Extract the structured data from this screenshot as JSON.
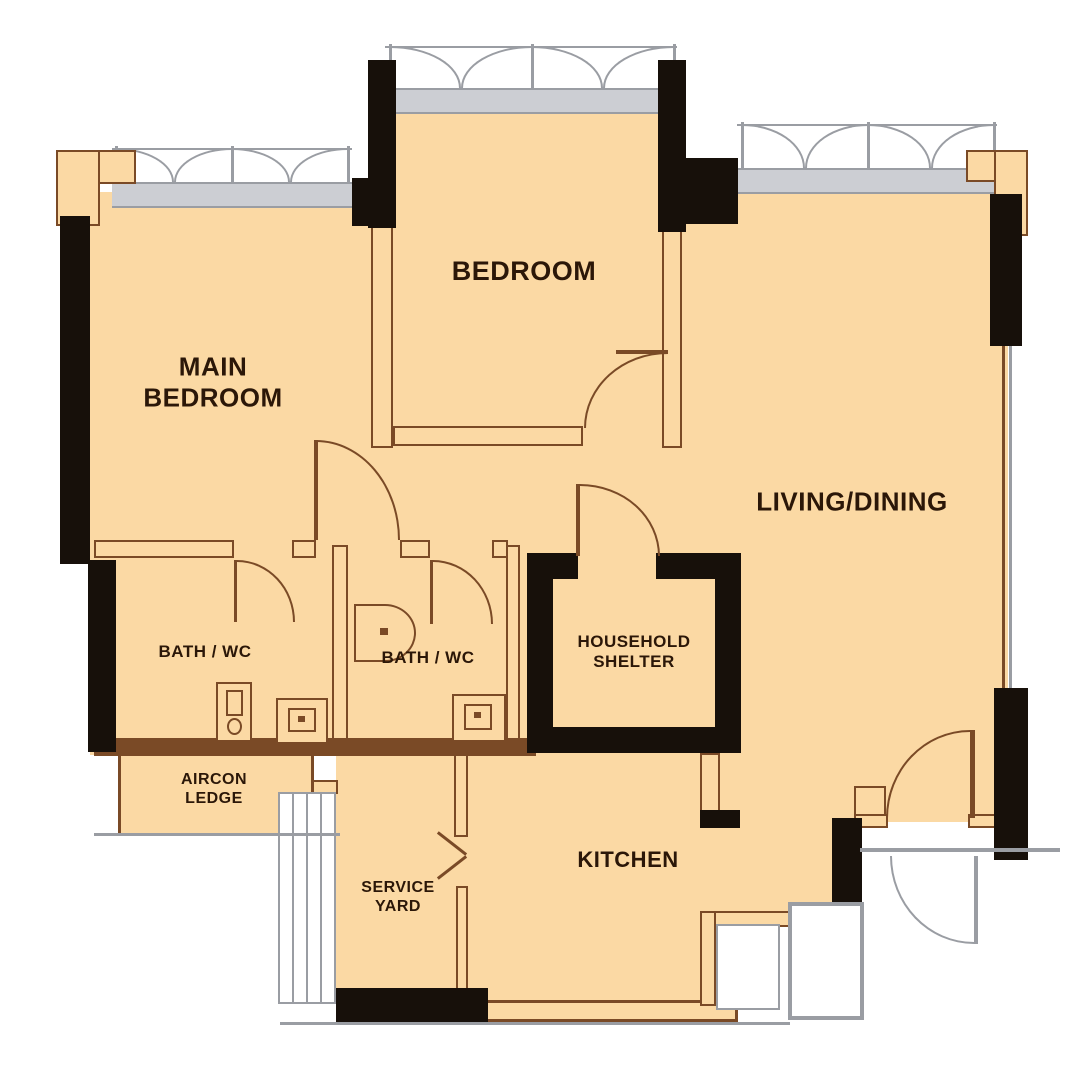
{
  "colors": {
    "floor": "#fbd9a4",
    "wallblack": "#17100a",
    "wallbrown": "#7a4a26",
    "wgray": "#9a9da3",
    "glass": "#ccced3",
    "text": "#2b1708"
  },
  "rooms": {
    "main_bedroom": {
      "label_line1": "MAIN",
      "label_line2": "BEDROOM"
    },
    "bedroom": {
      "label": "BEDROOM"
    },
    "living_dining": {
      "label": "LIVING/DINING"
    },
    "bath1": {
      "label": "BATH / WC"
    },
    "bath2": {
      "label": "BATH / WC"
    },
    "household_shelter": {
      "label_line1": "HOUSEHOLD",
      "label_line2": "SHELTER"
    },
    "aircon_ledge": {
      "label_line1": "AIRCON",
      "label_line2": "LEDGE"
    },
    "service_yard": {
      "label_line1": "SERVICE",
      "label_line2": "YARD"
    },
    "kitchen": {
      "label": "KITCHEN"
    }
  }
}
